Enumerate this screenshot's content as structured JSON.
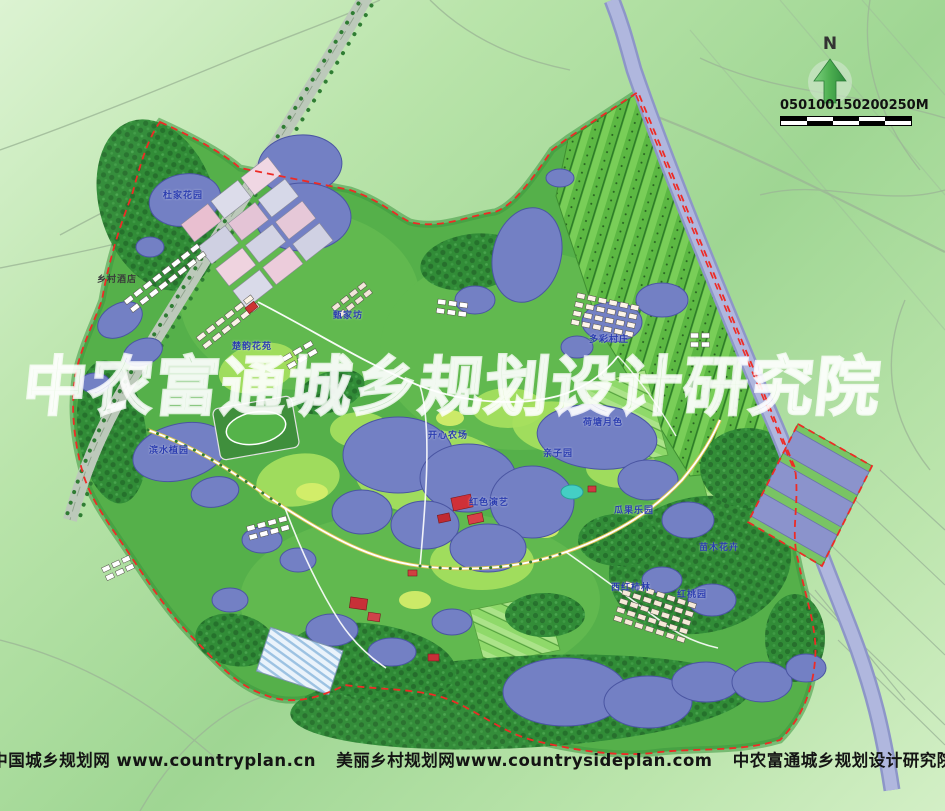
{
  "palette": {
    "bg_light": "#dcf3d2",
    "bg_mid": "#9fd693",
    "site_green": "#55b04a",
    "forest_green": "#2f8a36",
    "water": "#7380c4",
    "water_edge": "#4a55a2",
    "canal": "#a8afd9",
    "field_green": "#5cb843",
    "boundary_red": "#ee2b25",
    "road_band": "#bcc9ba",
    "watermark_white": "#ffffff",
    "label_blue": "#2b3db0",
    "footer_text": "#141414",
    "north_arrow_green": "#4cae50"
  },
  "compass": {
    "label": "N"
  },
  "scale_bar": {
    "ticks": [
      "0",
      "50",
      "100",
      "150",
      "200",
      "250M"
    ]
  },
  "watermark": {
    "text": "中农富通城乡规划设计研究院"
  },
  "footer": {
    "site1": "中国城乡规划网 www.countryplan.cn",
    "site2": "美丽乡村规划网www.countrysideplan.com",
    "org": "中农富通城乡规划设计研究院"
  },
  "map": {
    "labels": [
      {
        "text": "杜家花园",
        "x": 163,
        "y": 192,
        "color": "blue"
      },
      {
        "text": "乡村酒店",
        "x": 97,
        "y": 276,
        "color": "dark"
      },
      {
        "text": "甄家坊",
        "x": 333,
        "y": 312,
        "color": "blue"
      },
      {
        "text": "楚韵花苑",
        "x": 232,
        "y": 343,
        "color": "blue"
      },
      {
        "text": "多彩村庄",
        "x": 589,
        "y": 336,
        "color": "blue"
      },
      {
        "text": "荷塘月色",
        "x": 583,
        "y": 419,
        "color": "blue"
      },
      {
        "text": "开心农场",
        "x": 428,
        "y": 432,
        "color": "blue"
      },
      {
        "text": "亲子园",
        "x": 543,
        "y": 450,
        "color": "blue"
      },
      {
        "text": "红色演艺",
        "x": 469,
        "y": 499,
        "color": "blue"
      },
      {
        "text": "瓜果乐园",
        "x": 614,
        "y": 507,
        "color": "blue"
      },
      {
        "text": "苗木花卉",
        "x": 699,
        "y": 544,
        "color": "blue"
      },
      {
        "text": "西红柿林",
        "x": 611,
        "y": 584,
        "color": "blue"
      },
      {
        "text": "红桃园",
        "x": 677,
        "y": 591,
        "color": "blue"
      },
      {
        "text": "滨水植园",
        "x": 149,
        "y": 447,
        "color": "blue"
      }
    ]
  }
}
